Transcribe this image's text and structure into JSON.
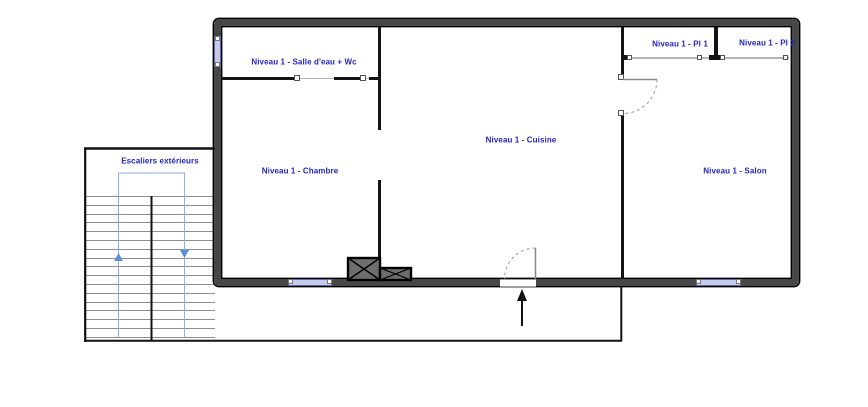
{
  "colors": {
    "label_text": "#2525c4",
    "wall_fill": "#474747",
    "window_fill": "#c6caee",
    "stair_guide_blue": "#8ab1e0"
  },
  "rooms": {
    "salle_eau": {
      "label": "Niveau 1 - Salle d'eau + Wc"
    },
    "chambre": {
      "label": "Niveau 1 - Chambre"
    },
    "cuisine": {
      "label": "Niveau 1 - Cuisine"
    },
    "salon": {
      "label": "Niveau 1 - Salon"
    },
    "placard_1": {
      "label": "Niveau 1 - Pl 1"
    },
    "placard_2": {
      "label": "Niveau 1 - Pl 2"
    }
  },
  "stairs": {
    "label": "Escaliers extérieurs",
    "tread_count": 17
  }
}
